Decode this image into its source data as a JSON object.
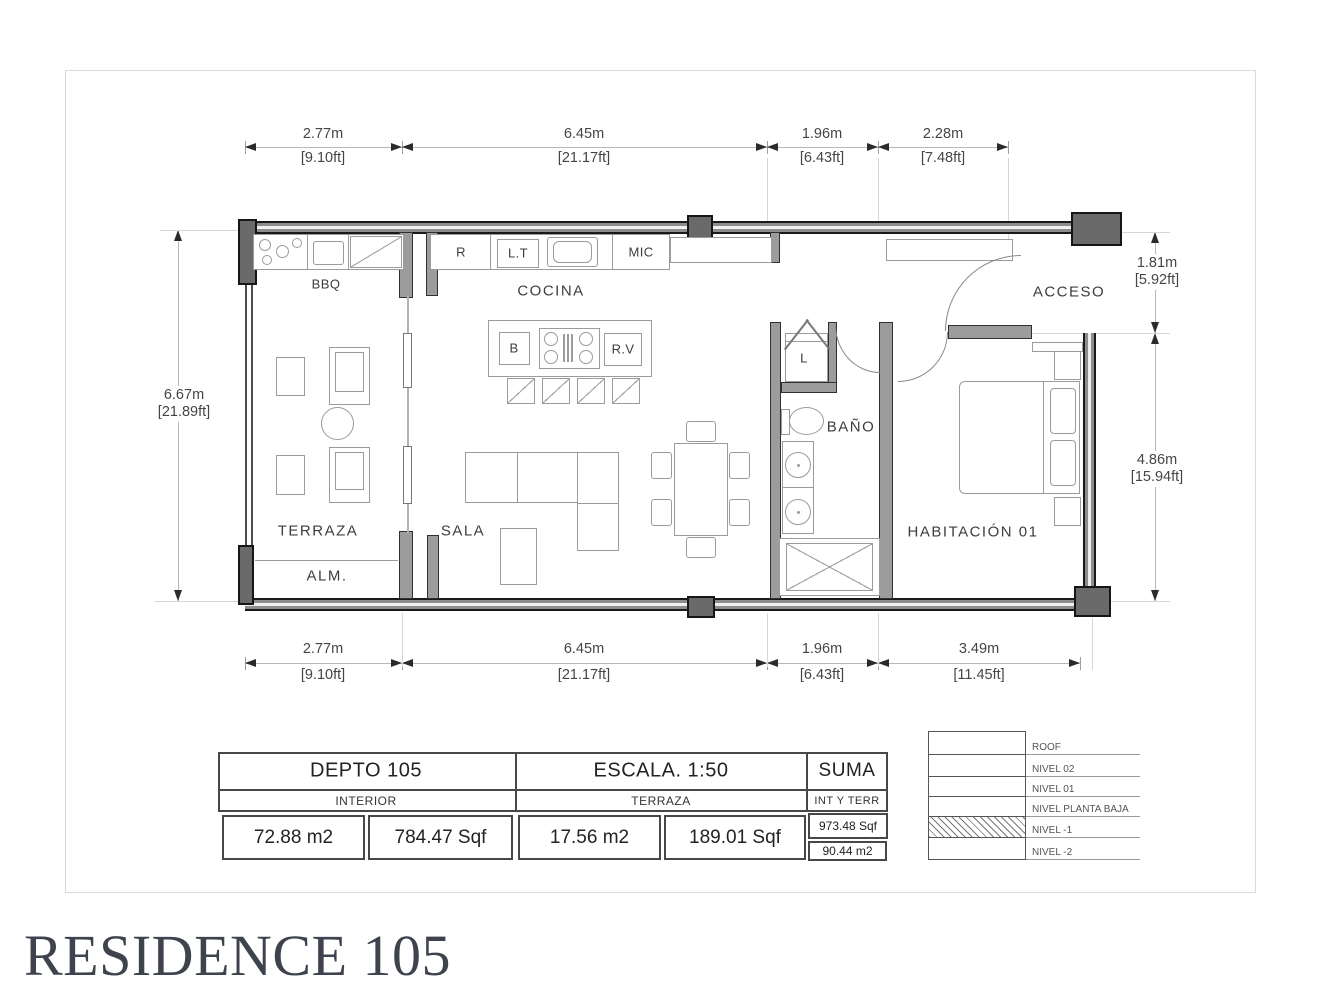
{
  "title": "RESIDENCE 105",
  "rooms": {
    "terraza": "TERRAZA",
    "alm": "ALM.",
    "sala": "SALA",
    "cocina": "COCINA",
    "bbq": "BBQ",
    "bano": "BAÑO",
    "habitacion": "HABITACIÓN 01",
    "acceso": "ACCESO"
  },
  "fixtures": {
    "refrigerator": "R",
    "lt": "L.T",
    "microwave": "MIC",
    "b": "B",
    "rv": "R.V",
    "laundry": "L"
  },
  "dims": {
    "top": [
      {
        "m": "2.77m",
        "ft": "[9.10ft]"
      },
      {
        "m": "6.45m",
        "ft": "[21.17ft]"
      },
      {
        "m": "1.96m",
        "ft": "[6.43ft]"
      },
      {
        "m": "2.28m",
        "ft": "[7.48ft]"
      }
    ],
    "bottom": [
      {
        "m": "2.77m",
        "ft": "[9.10ft]"
      },
      {
        "m": "6.45m",
        "ft": "[21.17ft]"
      },
      {
        "m": "1.96m",
        "ft": "[6.43ft]"
      },
      {
        "m": "3.49m",
        "ft": "[11.45ft]"
      }
    ],
    "left": {
      "m": "6.67m",
      "ft": "[21.89ft]"
    },
    "right": [
      {
        "m": "1.81m",
        "ft": "[5.92ft]"
      },
      {
        "m": "4.86m",
        "ft": "[15.94ft]"
      }
    ]
  },
  "info_table": {
    "interior": {
      "title": "DEPTO 105",
      "subtitle": "INTERIOR",
      "m2": "72.88 m2",
      "sqf": "784.47 Sqf"
    },
    "terraza": {
      "title": "ESCALA. 1:50",
      "subtitle": "TERRAZA",
      "m2": "17.56 m2",
      "sqf": "189.01 Sqf"
    },
    "suma": {
      "title": "SUMA",
      "subtitle": "INT Y TERR",
      "sqf": "973.48 Sqf",
      "m2": "90.44 m2"
    }
  },
  "levels": {
    "items": [
      "ROOF",
      "NIVEL 02",
      "NIVEL 01",
      "NIVEL PLANTA BAJA",
      "NIVEL -1",
      "NIVEL -2"
    ]
  },
  "colors": {
    "wall": "#8d8d8d",
    "column": "#6a6a6a",
    "title_text": "#3e434e",
    "line": "#9b9b9b"
  }
}
